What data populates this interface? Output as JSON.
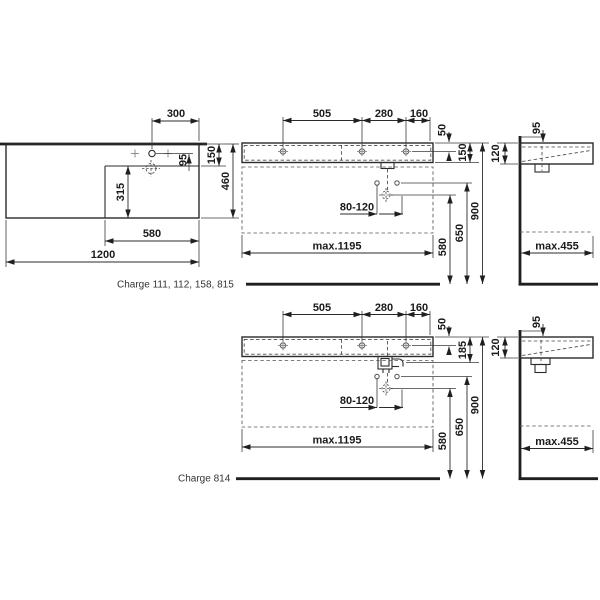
{
  "captions": {
    "series_a": "Charge 111, 112, 158, 815",
    "series_b": "Charge 814"
  },
  "colors": {
    "line": "#2b2b2b",
    "background": "#ffffff"
  },
  "plan_view": {
    "overall_width": "1200",
    "basin_width": "580",
    "overall_depth": "460",
    "basin_depth": "315",
    "tap_offset": "300",
    "tap_to_basin_edge": "95",
    "rear_to_basin_edge": "150"
  },
  "front_view_a": {
    "tap_spacing_left": "505",
    "tap_spacing_mid": "280",
    "tap_spacing_right": "160",
    "rim_to_fixing": "50",
    "body_height": "150",
    "drain_adjust": "80-120",
    "drain_height": "580",
    "fixing_height": "650",
    "rim_height": "900",
    "max_width": "max.1195"
  },
  "side_view_a": {
    "drain_offset": "95",
    "front_edge_height": "120",
    "max_depth": "max.455"
  },
  "front_view_b": {
    "tap_spacing_left": "505",
    "tap_spacing_mid": "280",
    "tap_spacing_right": "160",
    "rim_to_fixing": "50",
    "body_height": "185",
    "drain_adjust": "80-120",
    "drain_height": "580",
    "fixing_height": "650",
    "rim_height": "900",
    "max_width": "max.1195"
  },
  "side_view_b": {
    "drain_offset": "95",
    "front_edge_height": "120",
    "max_depth": "max.455"
  }
}
